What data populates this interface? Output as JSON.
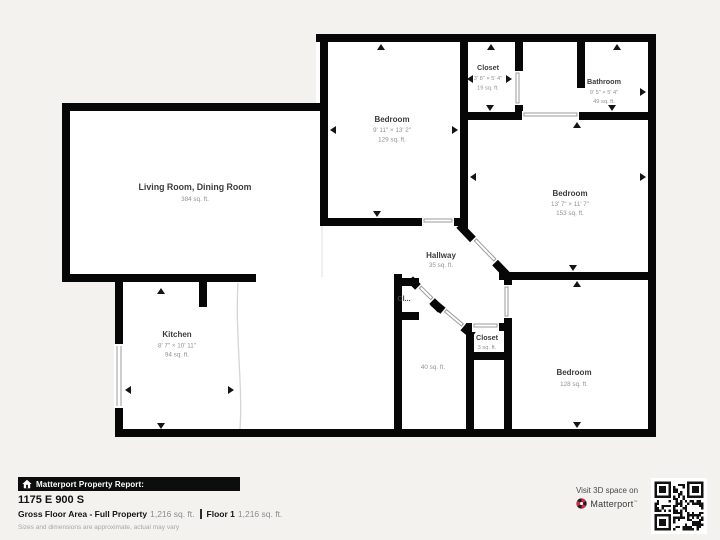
{
  "plan": {
    "rooms": [
      {
        "id": "living",
        "name": "Living Room, Dining Room",
        "dims": "",
        "area": "384 sq. ft."
      },
      {
        "id": "bedroom_top",
        "name": "Bedroom",
        "dims": "9' 11\" × 13' 2\"",
        "area": "129 sq. ft."
      },
      {
        "id": "closet_top",
        "name": "Closet",
        "dims": "3' 8\" × 5' 4\"",
        "area": "19 sq. ft."
      },
      {
        "id": "bathroom",
        "name": "Bathroom",
        "dims": "9' 5\" × 5' 4\"",
        "area": "49 sq. ft."
      },
      {
        "id": "bedroom_right",
        "name": "Bedroom",
        "dims": "13' 7\" × 11' 7\"",
        "area": "153 sq. ft."
      },
      {
        "id": "hallway",
        "name": "Hallway",
        "dims": "",
        "area": "35 sq. ft."
      },
      {
        "id": "kitchen",
        "name": "Kitchen",
        "dims": "8' 7\" × 10' 11\"",
        "area": "94 sq. ft."
      },
      {
        "id": "closet_cl",
        "name": "Cl...",
        "dims": "",
        "area": ""
      },
      {
        "id": "closet_small",
        "name": "Closet",
        "dims": "",
        "area": "3 sq. ft."
      },
      {
        "id": "utility",
        "name": "",
        "dims": "",
        "area": "40 sq. ft."
      },
      {
        "id": "bedroom_bottom",
        "name": "Bedroom",
        "dims": "",
        "area": "128 sq. ft."
      }
    ]
  },
  "footer": {
    "report_bar_label": "Matterport Property Report:",
    "address": "1175 E 900 S",
    "gross_label": "Gross Floor Area - Full Property",
    "gross_value": "1,216 sq. ft.",
    "floor_label": "Floor 1",
    "floor_value": "1,216 sq. ft.",
    "disclaimer": "Sizes and dimensions are approximate, actual may vary"
  },
  "cta": {
    "line1": "Visit 3D space on",
    "brand": "Matterport",
    "brand_mark": "™"
  },
  "colors": {
    "background": "#f3f2ef",
    "wall": "#070707",
    "room_fill": "#ffffff",
    "label": "#3c3c3c",
    "sublabel": "#929292",
    "bar_bg": "#0d0d0d",
    "brand_red": "#d62246"
  }
}
